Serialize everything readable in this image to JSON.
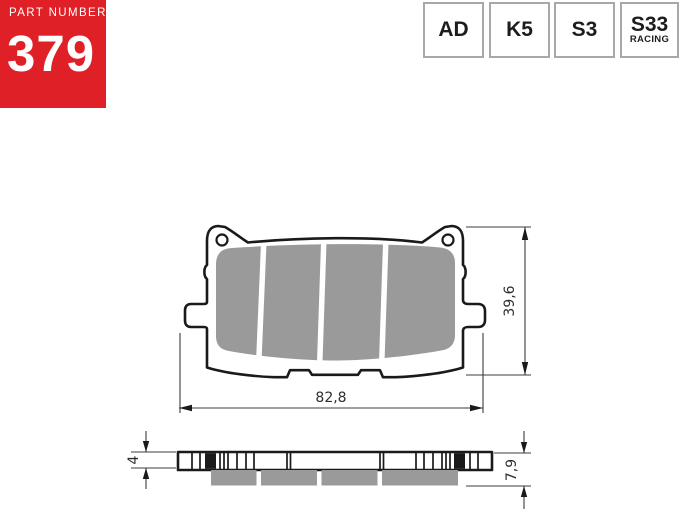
{
  "colors": {
    "red": "#e02027",
    "ink": "#1a1a1a",
    "badge_border": "#a8a8a8",
    "badge_text": "#1d1d1b",
    "friction_gray": "#9a9a9a",
    "dimension_line": "#3c3c3c",
    "dimension_text": "#2e2e2e"
  },
  "part_panel": {
    "label": "PART NUMBER",
    "number": "379"
  },
  "compound_badges": [
    {
      "label": "AD"
    },
    {
      "label": "K5"
    },
    {
      "label": "S3"
    },
    {
      "label": "S33",
      "sublabel": "RACING"
    }
  ],
  "drawing": {
    "front_view": {
      "width_mm": "82,8",
      "height_mm": "39,6"
    },
    "side_view": {
      "backplate_thickness_mm": "4",
      "total_thickness_mm": "7,9"
    }
  }
}
